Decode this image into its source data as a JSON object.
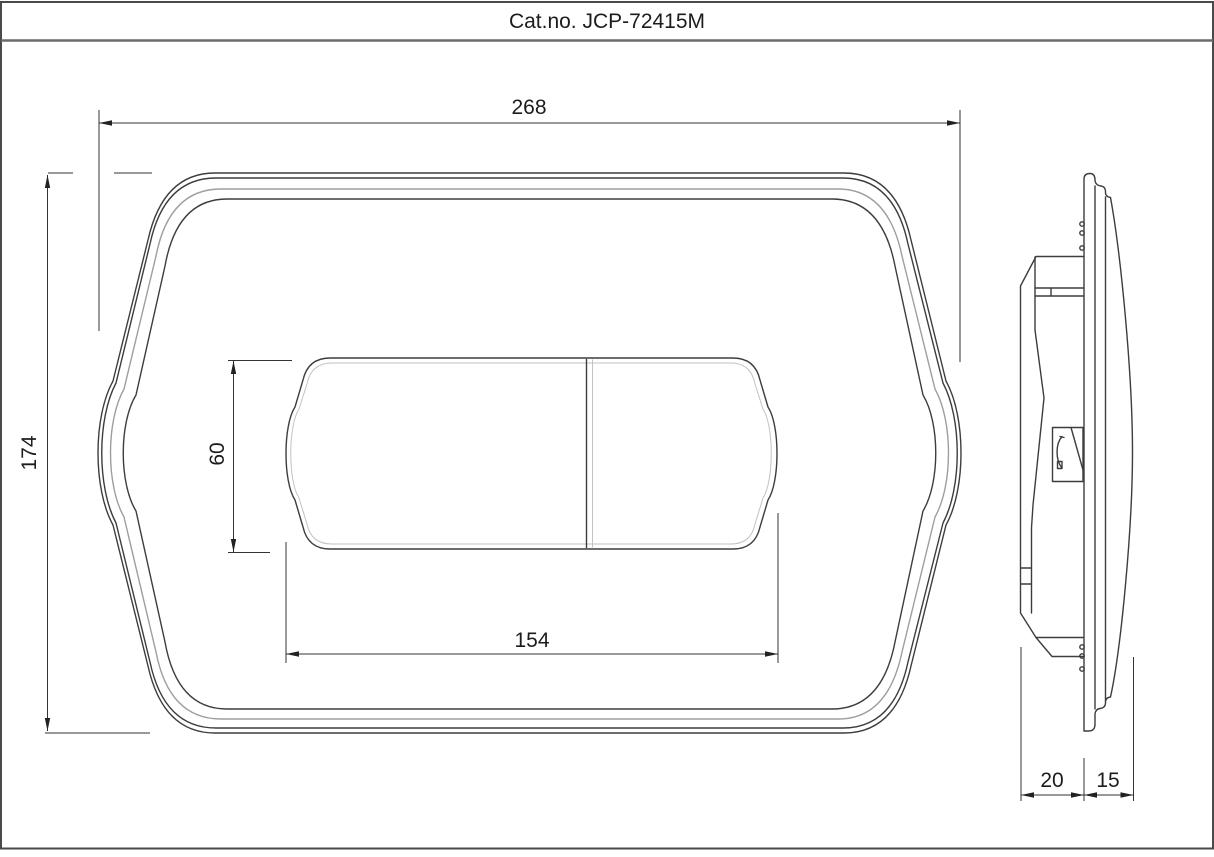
{
  "title_block": {
    "catalog": "Cat.no. JCP-72415M"
  },
  "front_view": {
    "overall_width": "268",
    "overall_height": "174",
    "buttons_width": "154",
    "buttons_height": "60"
  },
  "side_view": {
    "depth_in_wall": "20",
    "depth_protrusion": "15"
  },
  "colors": {
    "line": "#3d3d3d",
    "light_line": "#9e9e9e",
    "dimension_line": "#333333",
    "background": "#ffffff"
  }
}
